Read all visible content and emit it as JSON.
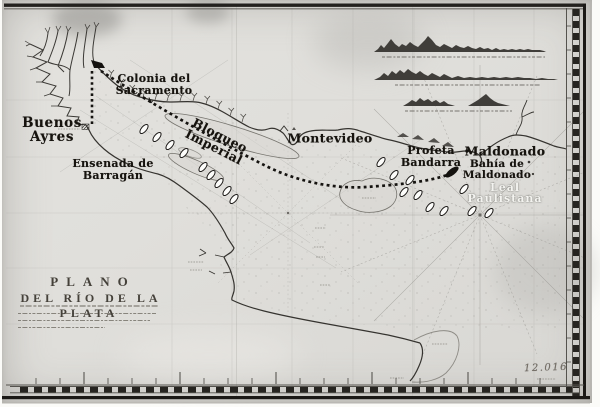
{
  "title_block": {
    "line1": "PLANO",
    "line2": "DEL RÍO DE LA PLATA"
  },
  "labels": {
    "colonia": {
      "line1": "Colonia del",
      "line2": "Sacramento"
    },
    "buenos_ayres": {
      "line1": "Buenos",
      "line2": "Ayres"
    },
    "ensenada": {
      "line1": "Ensenada de",
      "line2": "Barragán"
    },
    "bloqueo": {
      "line1": "Bloqueo",
      "line2": "Imperial"
    },
    "montevideo": {
      "text": "Montevideo"
    },
    "profeta": {
      "line1": "Profeta",
      "line2": "Bandarra"
    },
    "maldonado": {
      "text": "Maldonado"
    },
    "bahia_maldonado": {
      "line1": "Bahía de",
      "line2": "Maldonado"
    }
  },
  "watermark": {
    "line1": "Leal",
    "line2": "Paulistana"
  },
  "annotations": {
    "sheet_number": "12.016"
  },
  "colors": {
    "paper": "#e1e0dc",
    "border_ink": "#23211e",
    "label_ink": "#16130e",
    "route_ink": "#151310",
    "faint_line": "#8f8d88",
    "watermark": "#f6f5f1"
  }
}
